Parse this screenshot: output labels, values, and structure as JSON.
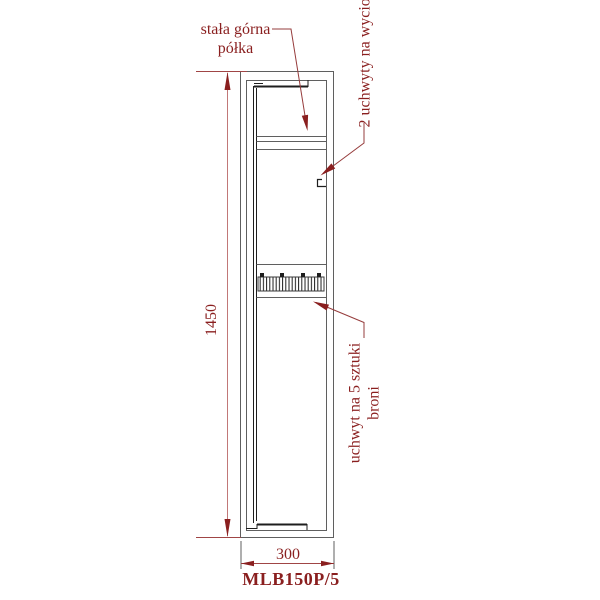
{
  "drawing": {
    "type": "technical-cabinet-side-view",
    "model": "MLB150P/5",
    "dimensions": {
      "height_mm": "1450",
      "width_mm": "300"
    },
    "annotations": {
      "top_shelf": {
        "line1": "stała górna",
        "line2": "półka"
      },
      "rod_holders": "2 uchwyty na wycior",
      "gun_holder": {
        "line1": "uchwyt na 5 sztuki",
        "line2": "broni"
      }
    }
  },
  "colors": {
    "background": "#ffffff",
    "annotation": "#8a1f1f",
    "leader": "#963c3c",
    "dimension-line": "#c17878",
    "dimension-ext": "#a04545",
    "drawing-gray": "#5f5f5f",
    "drawing-dark": "#1e1e1e"
  }
}
